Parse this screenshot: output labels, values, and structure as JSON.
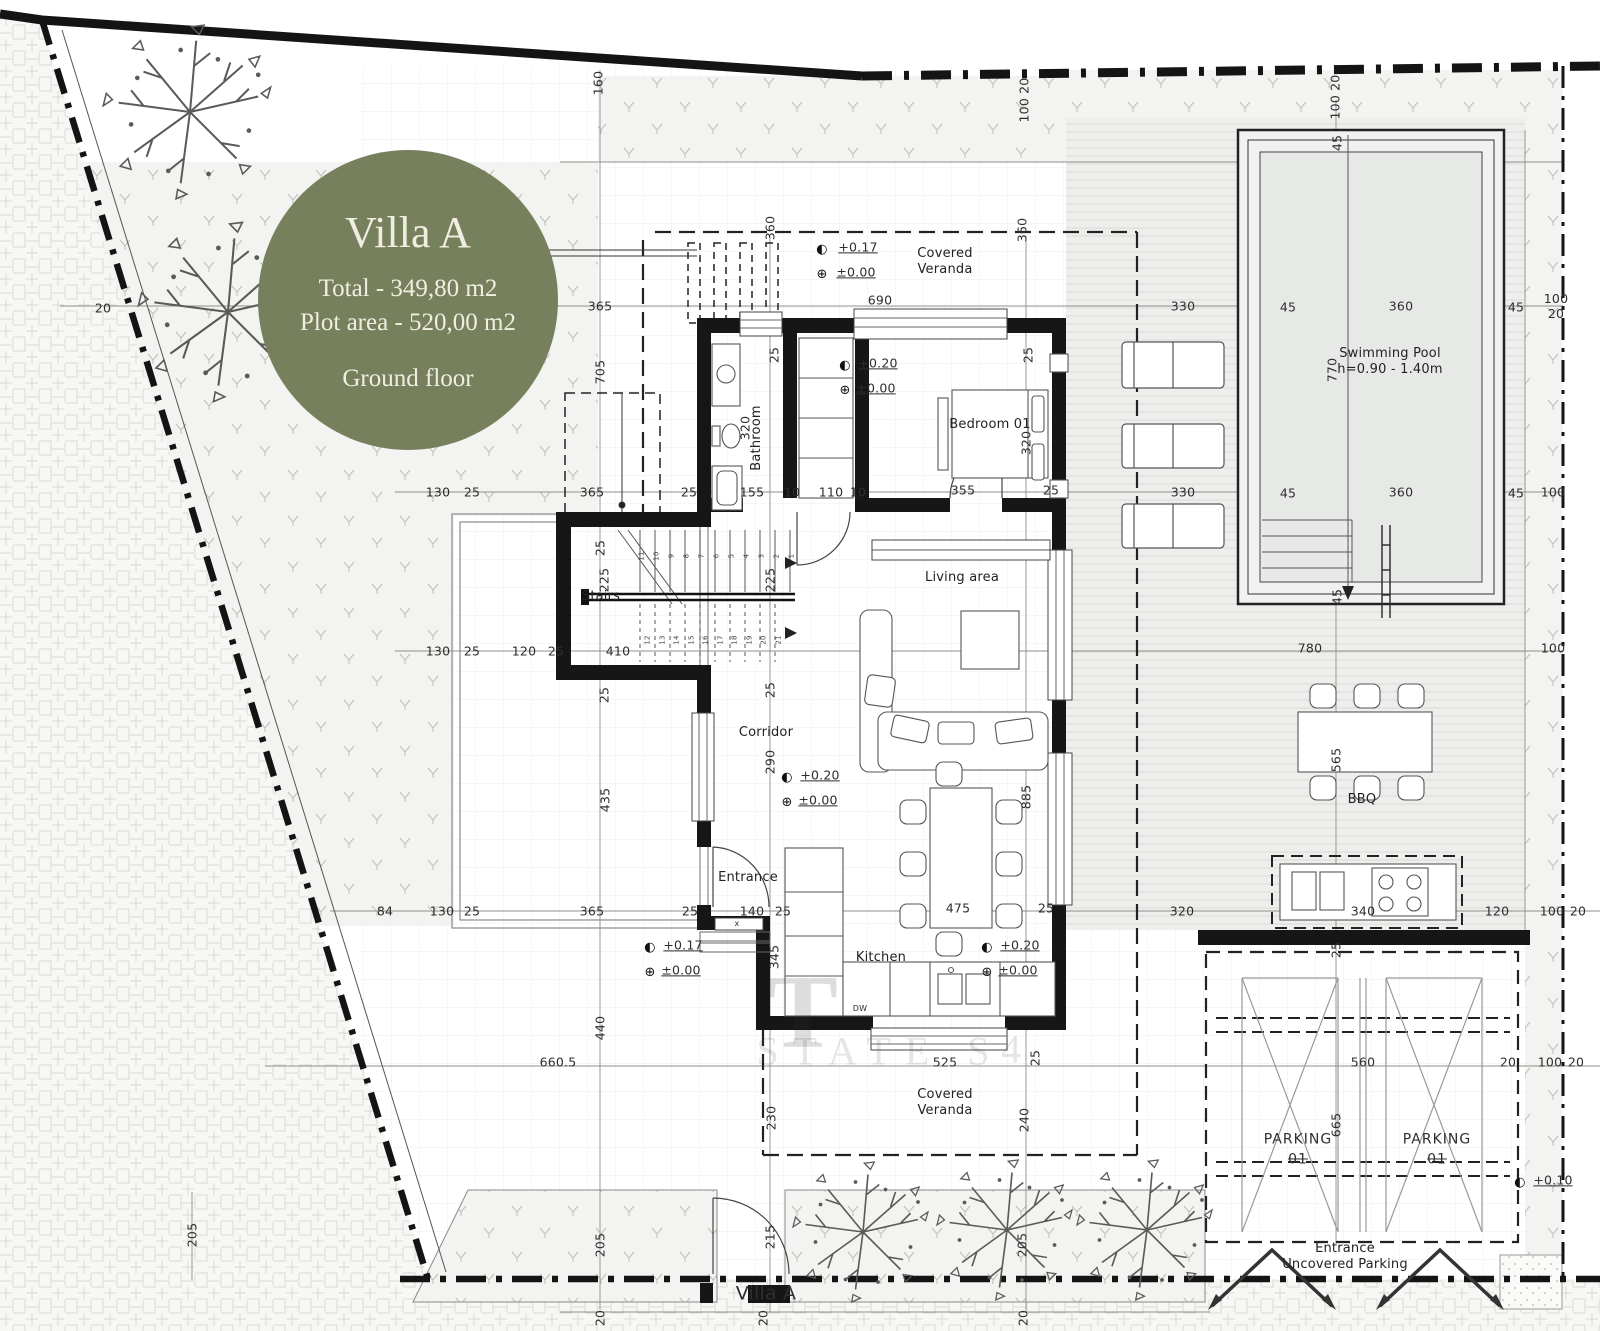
{
  "badge": {
    "title": "Villa A",
    "total": "Total - 349,80 m2",
    "plot": "Plot area - 520,00 m2",
    "floor": "Ground floor",
    "bg_color": "#76805d",
    "text_color": "#f1eee1"
  },
  "plan": {
    "rooms": [
      {
        "t": "Covered\nVeranda",
        "x": 945,
        "y": 262,
        "c": "room",
        "n": "room-label-covered-veranda-top"
      },
      {
        "t": "Covered\nVeranda",
        "x": 945,
        "y": 1103,
        "c": "room",
        "n": "room-label-covered-veranda-bottom"
      },
      {
        "t": "Bedroom 01",
        "x": 990,
        "y": 425,
        "c": "room",
        "n": "room-label-bedroom-01"
      },
      {
        "t": "Bathroom",
        "x": 757,
        "y": 438,
        "r": -90,
        "c": "room",
        "n": "room-label-bathroom"
      },
      {
        "t": "Stairs",
        "x": 601,
        "y": 597,
        "c": "room",
        "n": "room-label-stairs"
      },
      {
        "t": "Living area",
        "x": 962,
        "y": 578,
        "c": "room",
        "n": "room-label-living-area"
      },
      {
        "t": "Corridor",
        "x": 766,
        "y": 733,
        "c": "room",
        "n": "room-label-corridor"
      },
      {
        "t": "Entrance",
        "x": 748,
        "y": 878,
        "c": "room",
        "n": "room-label-entrance"
      },
      {
        "t": "Kitchen",
        "x": 881,
        "y": 958,
        "c": "room",
        "n": "room-label-kitchen"
      },
      {
        "t": "Swimming Pool\nh=0.90 - 1.40m",
        "x": 1390,
        "y": 362,
        "c": "room",
        "n": "room-label-swimming-pool"
      },
      {
        "t": "BBQ",
        "x": 1362,
        "y": 800,
        "c": "room",
        "n": "room-label-bbq"
      },
      {
        "t": "PARKING",
        "x": 1298,
        "y": 1140,
        "c": "pk",
        "n": "room-label-parking-1"
      },
      {
        "t": "01",
        "x": 1298,
        "y": 1160,
        "c": "pk strike",
        "n": "parking-number-1"
      },
      {
        "t": "PARKING",
        "x": 1437,
        "y": 1140,
        "c": "pk",
        "n": "room-label-parking-2"
      },
      {
        "t": "01",
        "x": 1437,
        "y": 1160,
        "c": "pk strike",
        "n": "parking-number-2"
      },
      {
        "t": "Entrance\nUncovered Parking",
        "x": 1345,
        "y": 1257,
        "c": "room",
        "n": "room-label-entrance-uncovered-parking"
      },
      {
        "t": "Villa A",
        "x": 766,
        "y": 1294,
        "c": "big",
        "n": "gate-label-villa-a"
      },
      {
        "t": "DW",
        "x": 860,
        "y": 1009,
        "fs": 8,
        "n": "appliance-label-dw"
      },
      {
        "t": "x",
        "x": 737,
        "y": 924,
        "fs": 8,
        "n": "window-mark-x"
      }
    ],
    "dimensions": [
      {
        "t": "20",
        "x": 103,
        "y": 308
      },
      {
        "t": "365",
        "x": 600,
        "y": 306
      },
      {
        "t": "690",
        "x": 880,
        "y": 300
      },
      {
        "t": "330",
        "x": 1183,
        "y": 306
      },
      {
        "t": "45",
        "x": 1288,
        "y": 307
      },
      {
        "t": "360",
        "x": 1401,
        "y": 306
      },
      {
        "t": "45",
        "x": 1516,
        "y": 307
      },
      {
        "t": "100 20",
        "x": 1556,
        "y": 306
      },
      {
        "t": "130",
        "x": 438,
        "y": 492
      },
      {
        "t": "25",
        "x": 472,
        "y": 492
      },
      {
        "t": "365",
        "x": 592,
        "y": 492
      },
      {
        "t": "25",
        "x": 689,
        "y": 492
      },
      {
        "t": "155",
        "x": 752,
        "y": 492
      },
      {
        "t": "10",
        "x": 792,
        "y": 492
      },
      {
        "t": "110",
        "x": 831,
        "y": 492
      },
      {
        "t": "10",
        "x": 858,
        "y": 492
      },
      {
        "t": "355",
        "x": 963,
        "y": 490
      },
      {
        "t": "25",
        "x": 1051,
        "y": 490
      },
      {
        "t": "330",
        "x": 1183,
        "y": 492
      },
      {
        "t": "45",
        "x": 1288,
        "y": 493
      },
      {
        "t": "360",
        "x": 1401,
        "y": 492
      },
      {
        "t": "45",
        "x": 1516,
        "y": 493
      },
      {
        "t": "100",
        "x": 1553,
        "y": 492
      },
      {
        "t": "130",
        "x": 438,
        "y": 651
      },
      {
        "t": "25",
        "x": 472,
        "y": 651
      },
      {
        "t": "120",
        "x": 524,
        "y": 651
      },
      {
        "t": "25",
        "x": 556,
        "y": 651
      },
      {
        "t": "410",
        "x": 618,
        "y": 651
      },
      {
        "t": "780",
        "x": 1310,
        "y": 648
      },
      {
        "t": "100",
        "x": 1553,
        "y": 648
      },
      {
        "t": "84",
        "x": 385,
        "y": 911
      },
      {
        "t": "130",
        "x": 442,
        "y": 911
      },
      {
        "t": "25",
        "x": 472,
        "y": 911
      },
      {
        "t": "365",
        "x": 592,
        "y": 911
      },
      {
        "t": "25",
        "x": 690,
        "y": 911
      },
      {
        "t": "140",
        "x": 752,
        "y": 911
      },
      {
        "t": "25",
        "x": 783,
        "y": 911
      },
      {
        "t": "475",
        "x": 958,
        "y": 908
      },
      {
        "t": "25",
        "x": 1046,
        "y": 908
      },
      {
        "t": "320",
        "x": 1182,
        "y": 911
      },
      {
        "t": "340",
        "x": 1363,
        "y": 911
      },
      {
        "t": "120",
        "x": 1497,
        "y": 911
      },
      {
        "t": "100",
        "x": 1552,
        "y": 911
      },
      {
        "t": "20",
        "x": 1578,
        "y": 911
      },
      {
        "t": "660.5",
        "x": 558,
        "y": 1062
      },
      {
        "t": "525",
        "x": 945,
        "y": 1062
      },
      {
        "t": "560",
        "x": 1363,
        "y": 1062
      },
      {
        "t": "20",
        "x": 1508,
        "y": 1062
      },
      {
        "t": "100",
        "x": 1550,
        "y": 1062
      },
      {
        "t": "20",
        "x": 1576,
        "y": 1062
      },
      {
        "t": "160",
        "x": 598,
        "y": 83,
        "r": -90
      },
      {
        "t": "100 20",
        "x": 1024,
        "y": 100,
        "r": -90
      },
      {
        "t": "100 20",
        "x": 1335,
        "y": 97,
        "r": -90
      },
      {
        "t": "45",
        "x": 1337,
        "y": 143,
        "r": -90
      },
      {
        "t": "360",
        "x": 770,
        "y": 228,
        "r": -90
      },
      {
        "t": "360",
        "x": 1022,
        "y": 230,
        "r": -90
      },
      {
        "t": "25",
        "x": 774,
        "y": 355,
        "r": -90
      },
      {
        "t": "25",
        "x": 1028,
        "y": 355,
        "r": -90
      },
      {
        "t": "705",
        "x": 600,
        "y": 372,
        "r": -90
      },
      {
        "t": "320",
        "x": 745,
        "y": 428,
        "r": -90
      },
      {
        "t": "320",
        "x": 1026,
        "y": 443,
        "r": -90
      },
      {
        "t": "770",
        "x": 1332,
        "y": 370,
        "r": -90
      },
      {
        "t": "25",
        "x": 600,
        "y": 548,
        "r": -90
      },
      {
        "t": "225",
        "x": 604,
        "y": 580,
        "r": -90
      },
      {
        "t": "225",
        "x": 770,
        "y": 580,
        "r": -90
      },
      {
        "t": "25",
        "x": 604,
        "y": 695,
        "r": -90
      },
      {
        "t": "25",
        "x": 770,
        "y": 690,
        "r": -90
      },
      {
        "t": "290",
        "x": 770,
        "y": 762,
        "r": -90
      },
      {
        "t": "435",
        "x": 605,
        "y": 800,
        "r": -90
      },
      {
        "t": "885",
        "x": 1026,
        "y": 797,
        "r": -90
      },
      {
        "t": "345",
        "x": 774,
        "y": 957,
        "r": -90
      },
      {
        "t": "440",
        "x": 600,
        "y": 1028,
        "r": -90
      },
      {
        "t": "25",
        "x": 1035,
        "y": 1058,
        "r": -90
      },
      {
        "t": "230",
        "x": 771,
        "y": 1118,
        "r": -90
      },
      {
        "t": "240",
        "x": 1024,
        "y": 1120,
        "r": -90
      },
      {
        "t": "45",
        "x": 1337,
        "y": 597,
        "r": -90
      },
      {
        "t": "565",
        "x": 1336,
        "y": 760,
        "r": -90
      },
      {
        "t": "25",
        "x": 1336,
        "y": 950,
        "r": -90
      },
      {
        "t": "665",
        "x": 1336,
        "y": 1125,
        "r": -90
      },
      {
        "t": "215",
        "x": 770,
        "y": 1237,
        "r": -90
      },
      {
        "t": "205",
        "x": 600,
        "y": 1245,
        "r": -90
      },
      {
        "t": "205",
        "x": 1022,
        "y": 1245,
        "r": -90
      },
      {
        "t": "205",
        "x": 192,
        "y": 1235,
        "r": -90
      },
      {
        "t": "20",
        "x": 600,
        "y": 1318,
        "r": -90
      },
      {
        "t": "20",
        "x": 763,
        "y": 1318,
        "r": -90
      },
      {
        "t": "20",
        "x": 1023,
        "y": 1318,
        "r": -90
      }
    ],
    "elevations": [
      {
        "t": "◐",
        "x": 822,
        "y": 250,
        "c": "sym",
        "n": "elevation-symbol"
      },
      {
        "t": "⊕",
        "x": 822,
        "y": 275,
        "c": "sym",
        "n": "elevation-symbol"
      },
      {
        "t": "+0.17",
        "x": 858,
        "y": 247,
        "c": "u",
        "n": "elevation-value"
      },
      {
        "t": "±0.00",
        "x": 856,
        "y": 272,
        "c": "u",
        "n": "elevation-value"
      },
      {
        "t": "◐",
        "x": 845,
        "y": 366,
        "c": "sym",
        "n": "elevation-symbol"
      },
      {
        "t": "⊕",
        "x": 845,
        "y": 391,
        "c": "sym",
        "n": "elevation-symbol"
      },
      {
        "t": "+0.20",
        "x": 878,
        "y": 363,
        "c": "u",
        "n": "elevation-value"
      },
      {
        "t": "±0.00",
        "x": 876,
        "y": 388,
        "c": "u",
        "n": "elevation-value"
      },
      {
        "t": "◐",
        "x": 787,
        "y": 778,
        "c": "sym",
        "n": "elevation-symbol"
      },
      {
        "t": "⊕",
        "x": 787,
        "y": 803,
        "c": "sym",
        "n": "elevation-symbol"
      },
      {
        "t": "+0.20",
        "x": 820,
        "y": 775,
        "c": "u",
        "n": "elevation-value"
      },
      {
        "t": "±0.00",
        "x": 818,
        "y": 800,
        "c": "u",
        "n": "elevation-value"
      },
      {
        "t": "◐",
        "x": 987,
        "y": 948,
        "c": "sym",
        "n": "elevation-symbol"
      },
      {
        "t": "⊕",
        "x": 987,
        "y": 973,
        "c": "sym",
        "n": "elevation-symbol"
      },
      {
        "t": "+0.20",
        "x": 1020,
        "y": 945,
        "c": "u",
        "n": "elevation-value"
      },
      {
        "t": "±0.00",
        "x": 1018,
        "y": 970,
        "c": "u",
        "n": "elevation-value"
      },
      {
        "t": "◐",
        "x": 650,
        "y": 948,
        "c": "sym",
        "n": "elevation-symbol"
      },
      {
        "t": "⊕",
        "x": 650,
        "y": 973,
        "c": "sym",
        "n": "elevation-symbol"
      },
      {
        "t": "+0.17",
        "x": 683,
        "y": 945,
        "c": "u",
        "n": "elevation-value"
      },
      {
        "t": "±0.00",
        "x": 681,
        "y": 970,
        "c": "u",
        "n": "elevation-value"
      },
      {
        "t": "◐",
        "x": 1520,
        "y": 1183,
        "c": "sym",
        "n": "elevation-symbol"
      },
      {
        "t": "+0.10",
        "x": 1553,
        "y": 1180,
        "c": "u",
        "n": "elevation-value"
      }
    ],
    "stair_numbers": [
      {
        "t": "1",
        "x": 792,
        "y": 556,
        "r": -90,
        "c": "tiny"
      },
      {
        "t": "2",
        "x": 777,
        "y": 556,
        "r": -90,
        "c": "tiny"
      },
      {
        "t": "3",
        "x": 762,
        "y": 556,
        "r": -90,
        "c": "tiny"
      },
      {
        "t": "4",
        "x": 747,
        "y": 556,
        "r": -90,
        "c": "tiny"
      },
      {
        "t": "5",
        "x": 732,
        "y": 556,
        "r": -90,
        "c": "tiny"
      },
      {
        "t": "6",
        "x": 717,
        "y": 556,
        "r": -90,
        "c": "tiny"
      },
      {
        "t": "7",
        "x": 702,
        "y": 556,
        "r": -90,
        "c": "tiny"
      },
      {
        "t": "8",
        "x": 687,
        "y": 556,
        "r": -90,
        "c": "tiny"
      },
      {
        "t": "9",
        "x": 672,
        "y": 556,
        "r": -90,
        "c": "tiny"
      },
      {
        "t": "10",
        "x": 657,
        "y": 556,
        "r": -90,
        "c": "tiny"
      },
      {
        "t": "11",
        "x": 642,
        "y": 556,
        "r": -90,
        "c": "tiny"
      },
      {
        "t": "12",
        "x": 648,
        "y": 640,
        "r": -90,
        "c": "tiny"
      },
      {
        "t": "13",
        "x": 663,
        "y": 640,
        "r": -90,
        "c": "tiny"
      },
      {
        "t": "14",
        "x": 677,
        "y": 640,
        "r": -90,
        "c": "tiny"
      },
      {
        "t": "15",
        "x": 692,
        "y": 640,
        "r": -90,
        "c": "tiny"
      },
      {
        "t": "16",
        "x": 706,
        "y": 640,
        "r": -90,
        "c": "tiny"
      },
      {
        "t": "17",
        "x": 721,
        "y": 640,
        "r": -90,
        "c": "tiny"
      },
      {
        "t": "18",
        "x": 735,
        "y": 640,
        "r": -90,
        "c": "tiny"
      },
      {
        "t": "19",
        "x": 750,
        "y": 640,
        "r": -90,
        "c": "tiny"
      },
      {
        "t": "20",
        "x": 764,
        "y": 640,
        "r": -90,
        "c": "tiny"
      },
      {
        "t": "21",
        "x": 779,
        "y": 640,
        "r": -90,
        "c": "tiny"
      }
    ],
    "watermark": [
      {
        "t": "STATE S",
        "x": 880,
        "y": 1052,
        "fs": 40,
        "c": "wm",
        "n": "watermark-fragment"
      },
      {
        "t": "4",
        "x": 1018,
        "y": 1050,
        "fs": 40,
        "c": "wm",
        "n": "watermark-fragment"
      },
      {
        "t": "T",
        "x": 803,
        "y": 1012,
        "fs": 105,
        "c": "wm2",
        "n": "watermark-fragment"
      }
    ]
  }
}
